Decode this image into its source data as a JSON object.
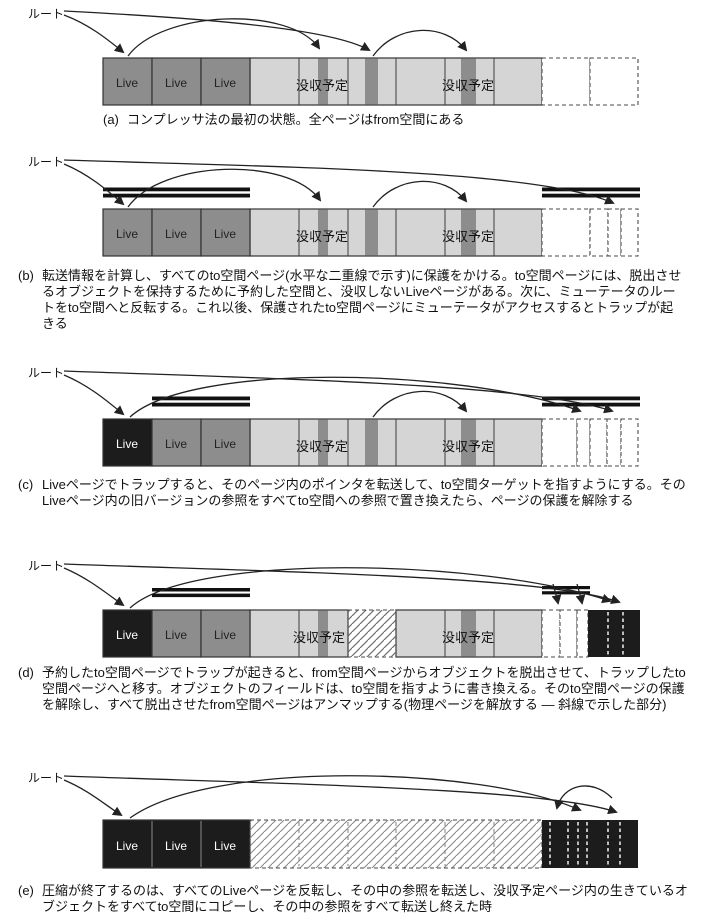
{
  "labels": {
    "root": "ルート",
    "live": "Live",
    "condemned": "没収予定"
  },
  "colors": {
    "live_page_gray": "#8d8d8d",
    "condemned_light_gray": "#d5d5d5",
    "live_object_stripe": "#8d8d8d",
    "flipped_black_page": "#1c1c1c",
    "cell_border": "#333333",
    "dashed_border": "#4a4a4a",
    "hatch_line": "#777777",
    "arrow_line": "#222222",
    "text": "#111111"
  },
  "captions": {
    "a": {
      "tag": "(a)",
      "text": "コンプレッサ法の最初の状態。全ページはfrom空間にある"
    },
    "b": {
      "tag": "(b)",
      "text": "転送情報を計算し、すべてのto空間ページ(水平な二重線で示す)に保護をかける。to空間ページには、脱出させるオブジェクトを保持するために予約した空間と、没収しないLiveページがある。次に、ミューテータのルートをto空間へと反転する。これ以後、保護されたto空間ページにミューテータがアクセスするとトラップが起きる"
    },
    "c": {
      "tag": "(c)",
      "text": "Liveページでトラップすると、そのページ内のポインタを転送して、to空間ターゲットを指すようにする。そのLiveページ内の旧バージョンの参照をすべてto空間への参照で置き換えたら、ページの保護を解除する"
    },
    "d": {
      "tag": "(d)",
      "text": "予約したto空間ページでトラップが起きると、from空間ページからオブジェクトを脱出させて、トラップしたto空間ページへと移す。オブジェクトのフィールドは、to空間を指すように書き換える。そのto空間ページの保護を解除し、すべて脱出させたfrom空間ページはアンマップする(物理ページを解放する ― 斜線で示した部分)"
    },
    "e": {
      "tag": "(e)",
      "text": "圧縮が終了するのは、すべてのLiveページを反転し、その中の参照を転送し、没収予定ページ内の生きているオブジェクトをすべてto空間にコピーし、その中の参照をすべて転送し終えた時"
    }
  }
}
